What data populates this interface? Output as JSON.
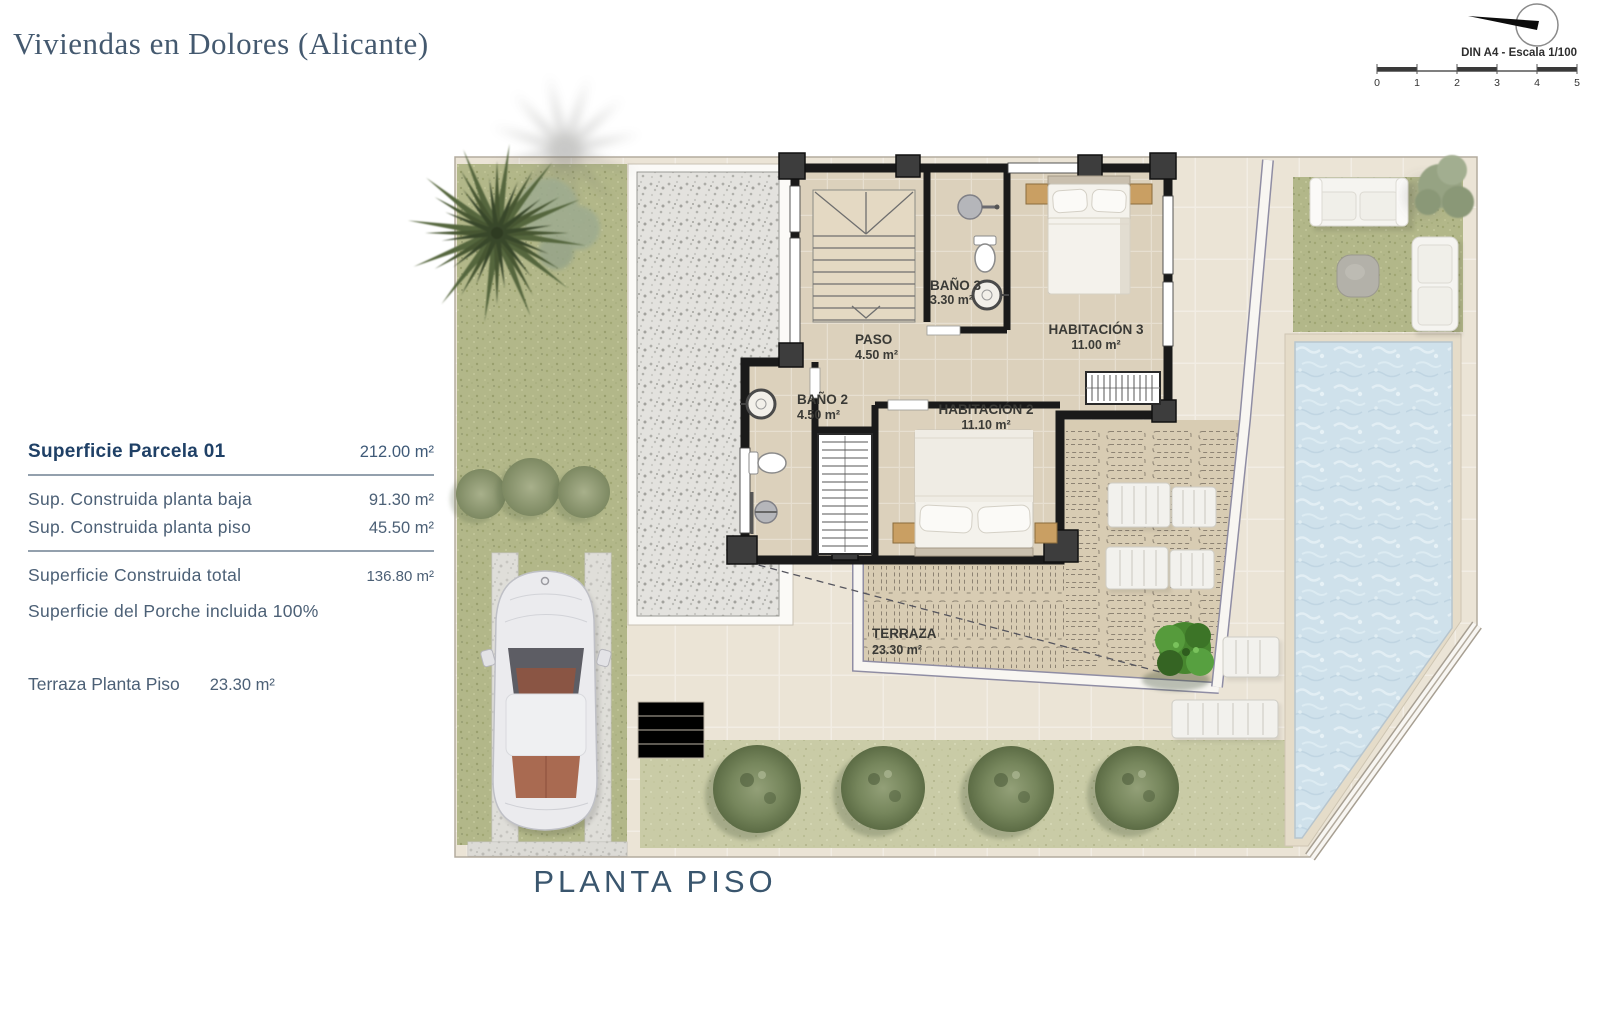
{
  "header": {
    "title": "Viviendas en Dolores (Alicante)"
  },
  "scale_widget": {
    "label": "DIN A4 - Escala 1/100",
    "ticks": [
      "0",
      "1",
      "2",
      "3",
      "4",
      "5"
    ]
  },
  "summary_table": {
    "rows": [
      {
        "label": "Superficie Parcela 01",
        "value": "212.00 m²"
      },
      {
        "label": "Sup. Construida planta baja",
        "value": "91.30 m²"
      },
      {
        "label": "Sup. Construida planta piso",
        "value": "45.50 m²"
      },
      {
        "label": "Superficie Construida total",
        "value": "136.80 m²"
      },
      {
        "label": "Superficie del Porche incluida 100%",
        "value": ""
      }
    ],
    "terraza_row": {
      "label": "Terraza Planta Piso",
      "value": "23.30 m²"
    }
  },
  "rooms": [
    {
      "name": "BAÑO 3",
      "area": "3.30 m²"
    },
    {
      "name": "PASO",
      "area": "4.50 m²"
    },
    {
      "name": "HABITACIÓN 3",
      "area": "11.00 m²"
    },
    {
      "name": "BAÑO 2",
      "area": "4.50 m²"
    },
    {
      "name": "HABITACIÓN 2",
      "area": "11.10 m²"
    },
    {
      "name": "TERRAZA",
      "area": "23.30 m²"
    }
  ],
  "plan_title": "PLANTA PISO",
  "colors": {
    "accent_navy": "#3e566e",
    "ground": "#ebe4d6",
    "grass": "#b2b789",
    "water": "#cfe1eb",
    "wall": "#1a1a1a"
  }
}
